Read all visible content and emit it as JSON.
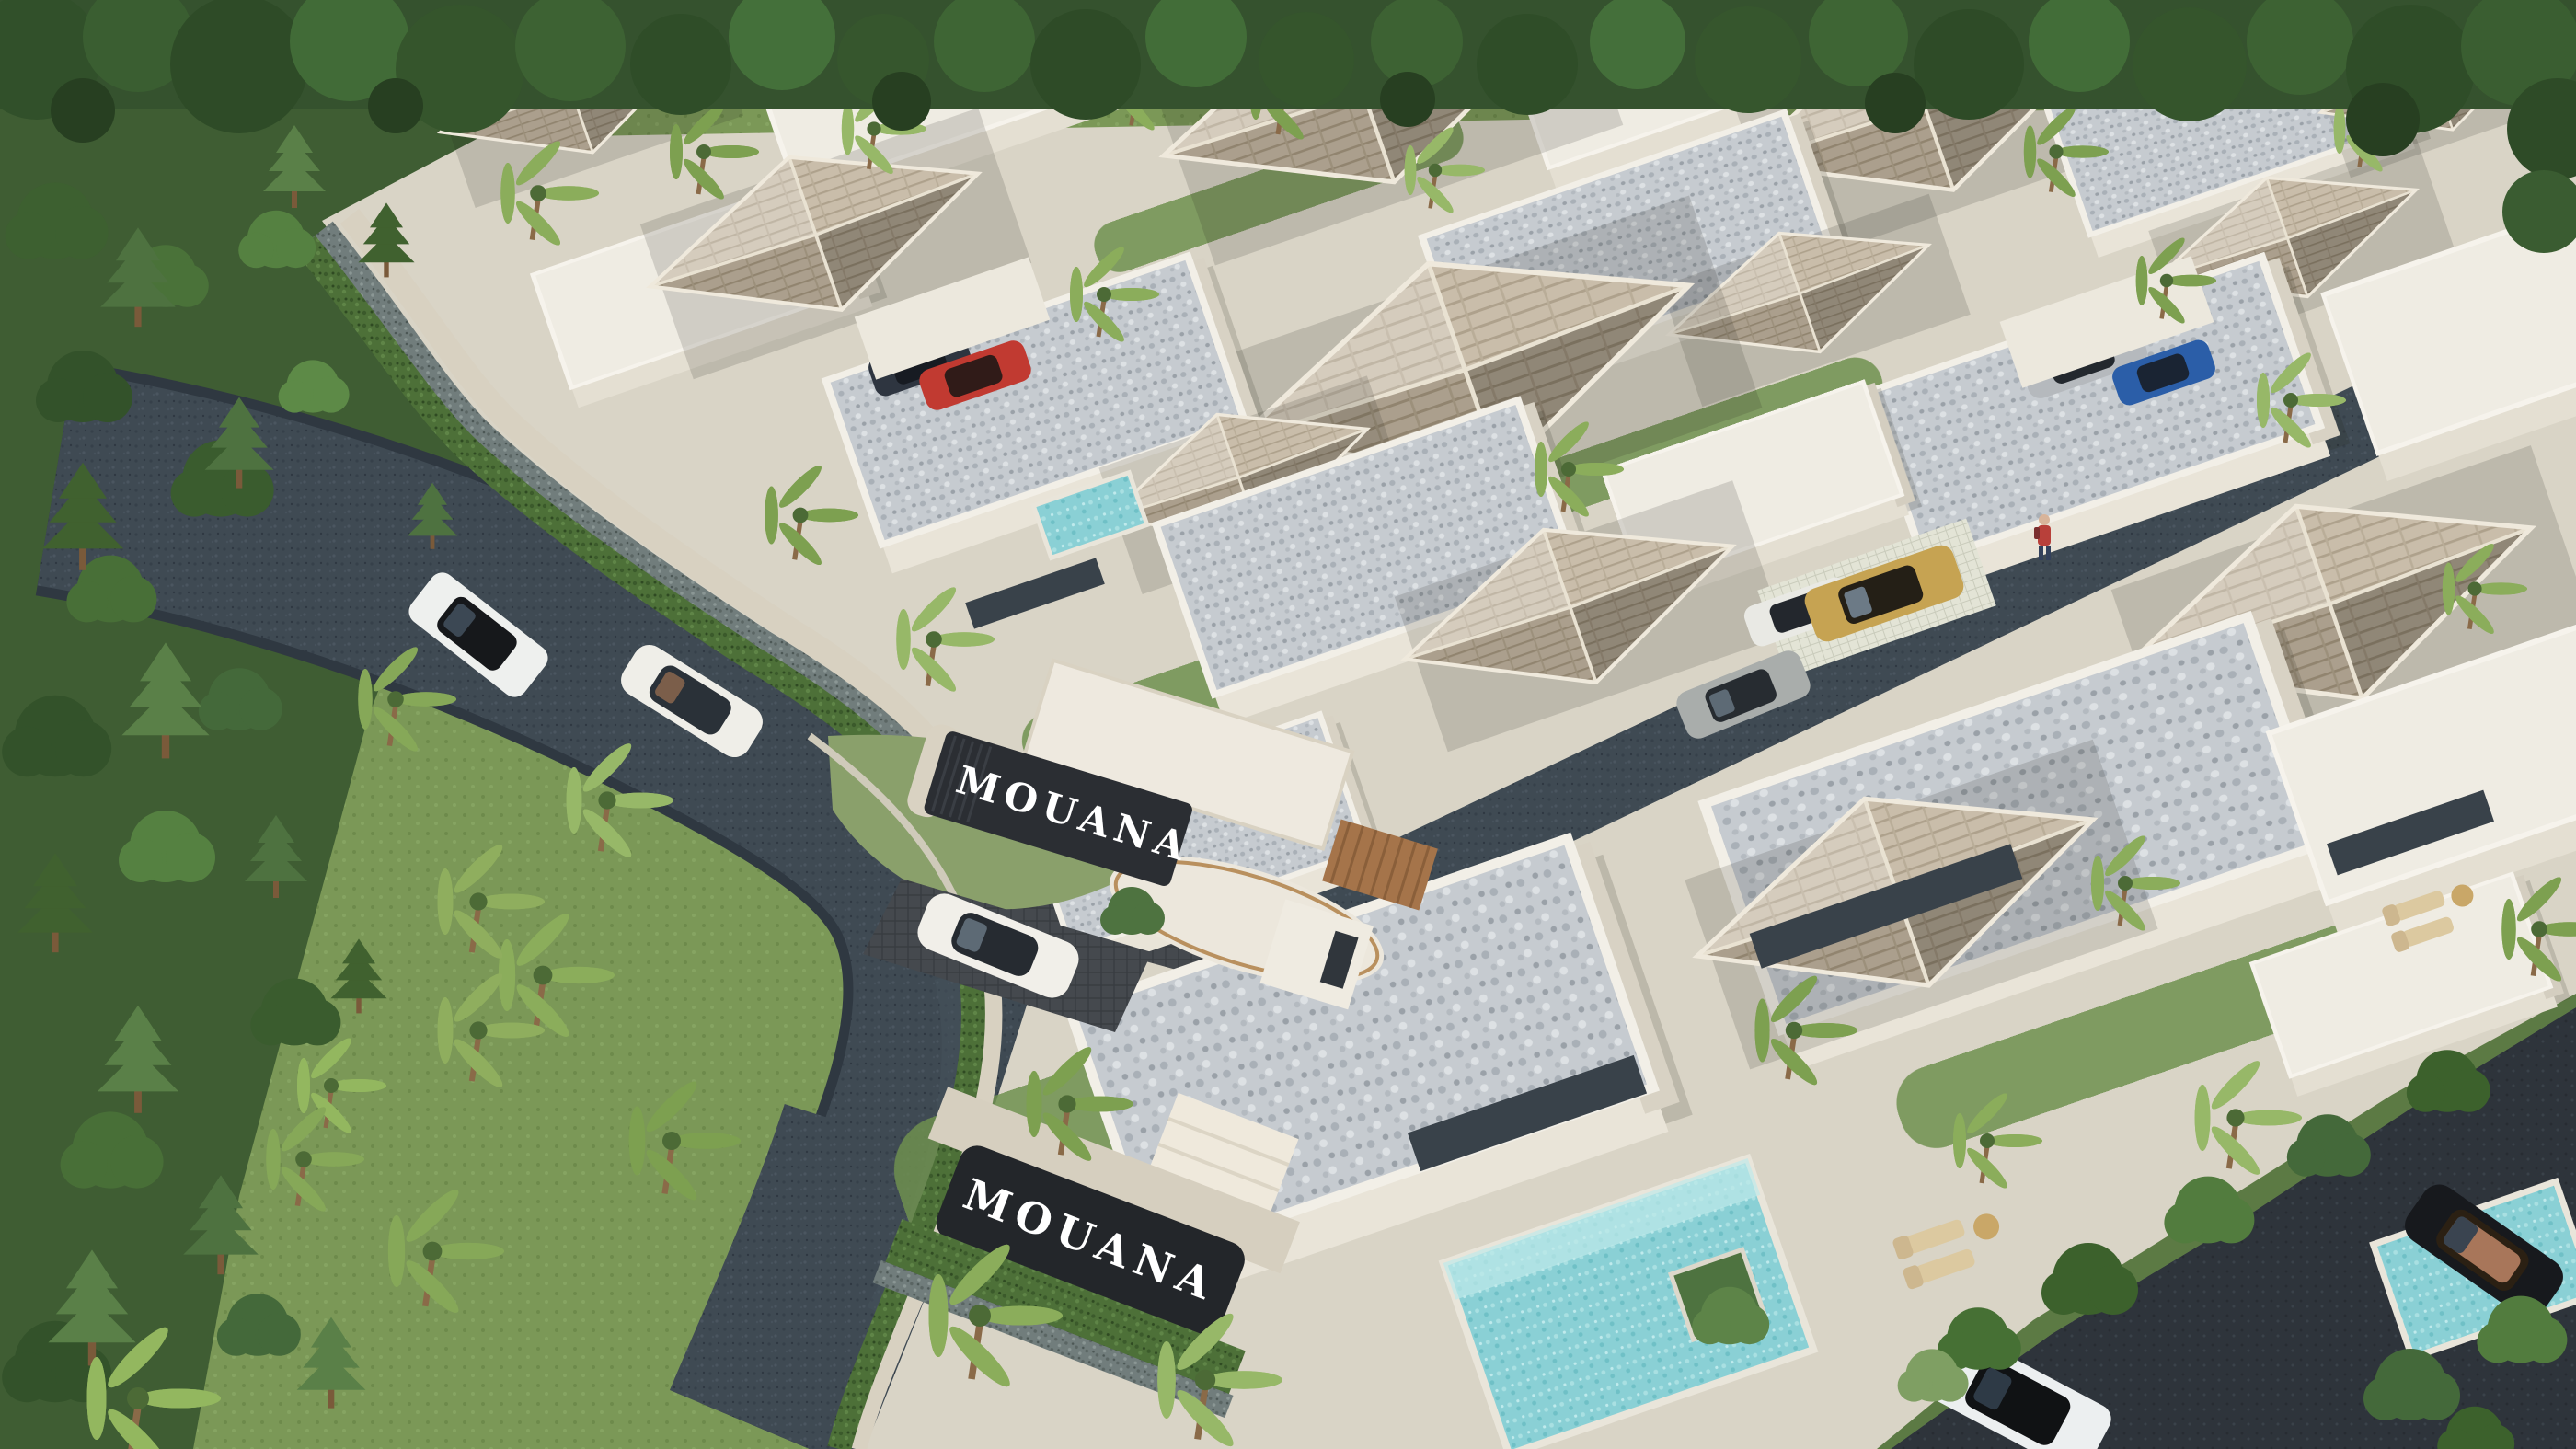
{
  "branding": {
    "name": "MOUANA",
    "entrance_sign": {
      "label": "MOUANA",
      "panel_color": "#2b2e33",
      "text_color": "#ffffff",
      "location": "entrance gate wall"
    },
    "lower_sign": {
      "label": "MOUANA",
      "panel_color": "#23262a",
      "text_color": "#ffffff",
      "location": "south villa wall"
    }
  },
  "palette": {
    "grass": "#7b9857",
    "forest_dark": "#2e4b27",
    "forest_mid": "#3d6233",
    "palm_green": "#8bad5b",
    "road_asphalt": "#3f4a53",
    "road_dark": "#2e343b",
    "villa_wall": "#efece3",
    "villa_wall_shade": "#d9d2c2",
    "roof_shingle": "#c3b6a1",
    "roof_shingle_shade": "#9a8d79",
    "roof_gravel": "#c6cbd0",
    "glass": "#39424a",
    "pool_water": "#8ad0d5",
    "hedge": "#4d7038",
    "stone_wall": "#717d7c",
    "wood": "#a5744a"
  },
  "scene": {
    "type": "aerial 3D architectural rendering",
    "description": "Tropical luxury pool-villa estate: white single-storey villas with taupe shingle hip roofs and speckled flat gravel roofs, palm trees, turquoise pools, a curving asphalt access road through dense forest, gabion perimeter walls with hedges, and a gated entrance with an illuminated MOUANA sign.",
    "signs_count": 2,
    "pools": [
      "main courtyard pool with tree planter",
      "right villa plunge pool with loungers",
      "upper cluster pool"
    ],
    "vehicles": [
      {
        "type": "suv",
        "color": "white, black roof",
        "location": "upper-left road"
      },
      {
        "type": "sedan",
        "color": "white",
        "location": "main road"
      },
      {
        "type": "sports car",
        "color": "white",
        "location": "entrance driveway"
      },
      {
        "type": "coupe",
        "color": "red",
        "location": "upper carport"
      },
      {
        "type": "coupe",
        "color": "dark blue",
        "location": "upper carport"
      },
      {
        "type": "suv",
        "color": "gold",
        "location": "villa forecourt"
      },
      {
        "type": "sedan",
        "color": "white",
        "location": "villa carport"
      },
      {
        "type": "sedan",
        "color": "silver",
        "location": "inner lane"
      },
      {
        "type": "sedan",
        "color": "silver",
        "location": "right carport"
      },
      {
        "type": "coupe",
        "color": "blue",
        "location": "right carport"
      },
      {
        "type": "sedan",
        "color": "black, tan interior",
        "location": "lower-right road"
      },
      {
        "type": "suv",
        "color": "white, black roof",
        "location": "bottom road"
      }
    ],
    "people": [
      {
        "description": "pedestrian in red top with backpack",
        "location": "inner walkway"
      }
    ]
  }
}
